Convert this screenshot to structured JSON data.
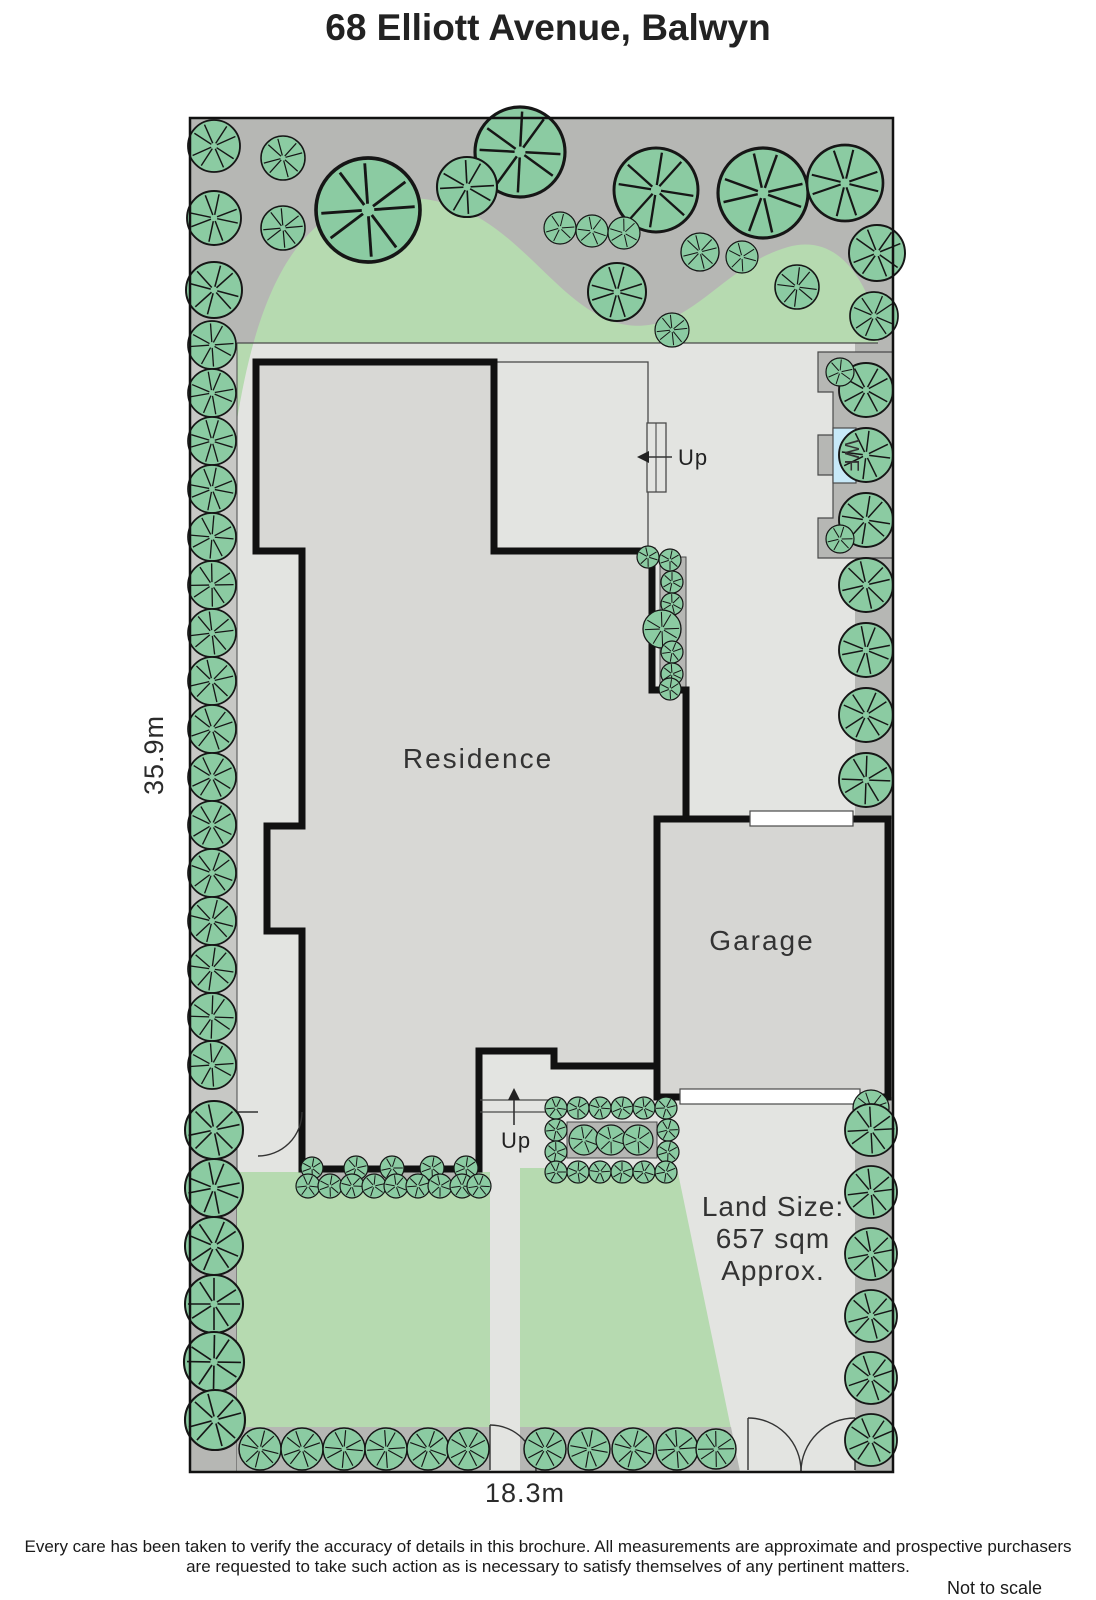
{
  "title": "68 Elliott Avenue, Balwyn",
  "labels": {
    "residence": "Residence",
    "garage": "Garage",
    "up_rear": "Up",
    "up_front": "Up",
    "water_feature": "WF",
    "land_size_line1": "Land Size:",
    "land_size_line2": "657 sqm",
    "land_size_line3": "Approx.",
    "depth_dim": "35.9m",
    "width_dim": "18.3m",
    "not_to_scale": "Not to scale"
  },
  "disclaimer": {
    "line1": "Every care has been taken to verify the accuracy of details in this brochure.  All measurements are approximate and prospective purchasers",
    "line2": "are requested to take such action as is necessary to satisfy themselves of any pertinent matters."
  },
  "colors": {
    "bed_gray": "#b6b7b4",
    "left_strip_gray": "#c7c8c5",
    "paving_gray": "#e3e4e1",
    "residence_fill": "#d8d8d5",
    "garage_fill": "#d6d6d3",
    "lawn_green": "#b6dab0",
    "tree_fill": "#8bcba2",
    "tree_stroke": "#161616",
    "wf_blue": "#c7e9f8",
    "wall_black": "#111111",
    "thin_line": "#4a4a4a"
  },
  "trees": {
    "top_garden": [
      [
        368,
        210,
        52
      ],
      [
        520,
        152,
        45
      ],
      [
        656,
        190,
        42
      ],
      [
        763,
        193,
        45
      ],
      [
        845,
        183,
        38
      ],
      [
        467,
        187,
        30
      ],
      [
        877,
        253,
        28
      ],
      [
        214,
        146,
        26
      ],
      [
        283,
        158,
        22
      ],
      [
        214,
        218,
        27
      ],
      [
        283,
        228,
        22
      ],
      [
        214,
        290,
        28
      ],
      [
        560,
        228,
        16
      ],
      [
        592,
        231,
        16
      ],
      [
        624,
        233,
        16
      ],
      [
        700,
        252,
        19
      ],
      [
        742,
        257,
        16
      ],
      [
        672,
        330,
        17
      ],
      [
        617,
        292,
        29
      ],
      [
        797,
        287,
        22
      ],
      [
        874,
        316,
        24
      ]
    ],
    "left_col": [
      [
        212,
        345,
        24
      ],
      [
        212,
        393,
        24
      ],
      [
        212,
        441,
        24
      ],
      [
        212,
        489,
        24
      ],
      [
        212,
        537,
        24
      ],
      [
        212,
        585,
        24
      ],
      [
        212,
        633,
        24
      ],
      [
        212,
        681,
        24
      ],
      [
        212,
        729,
        24
      ],
      [
        212,
        777,
        24
      ],
      [
        212,
        825,
        24
      ],
      [
        212,
        873,
        24
      ],
      [
        212,
        921,
        24
      ],
      [
        212,
        969,
        24
      ],
      [
        212,
        1017,
        24
      ],
      [
        212,
        1065,
        24
      ]
    ],
    "left_bottom": [
      [
        214,
        1130,
        29
      ],
      [
        214,
        1188,
        29
      ],
      [
        214,
        1246,
        29
      ],
      [
        214,
        1304,
        29
      ],
      [
        214,
        1362,
        30
      ],
      [
        215,
        1420,
        30
      ]
    ],
    "right_col_top": [
      [
        866,
        390,
        27
      ],
      [
        866,
        455,
        27
      ],
      [
        866,
        520,
        27
      ],
      [
        866,
        585,
        27
      ],
      [
        866,
        650,
        27
      ],
      [
        866,
        715,
        27
      ],
      [
        866,
        780,
        27
      ],
      [
        840,
        372,
        14
      ],
      [
        840,
        539,
        14
      ]
    ],
    "right_col_bottom": [
      [
        871,
        1108,
        18
      ],
      [
        871,
        1130,
        26
      ],
      [
        871,
        1192,
        26
      ],
      [
        871,
        1254,
        26
      ],
      [
        871,
        1316,
        26
      ],
      [
        871,
        1378,
        26
      ],
      [
        871,
        1440,
        26
      ]
    ],
    "east_hedge": [
      [
        648,
        557,
        11
      ],
      [
        670,
        560,
        11
      ],
      [
        672,
        582,
        11
      ],
      [
        672,
        604,
        11
      ],
      [
        662,
        629,
        19
      ],
      [
        672,
        652,
        11
      ],
      [
        672,
        674,
        11
      ],
      [
        670,
        689,
        11
      ]
    ],
    "south_hedge": [
      [
        312,
        1168,
        11
      ],
      [
        356,
        1168,
        12
      ],
      [
        392,
        1168,
        12
      ],
      [
        432,
        1168,
        12
      ],
      [
        466,
        1168,
        12
      ],
      [
        308,
        1186,
        12
      ],
      [
        330,
        1186,
        12
      ],
      [
        352,
        1186,
        12
      ],
      [
        374,
        1186,
        12
      ],
      [
        396,
        1186,
        12
      ],
      [
        418,
        1186,
        12
      ],
      [
        440,
        1186,
        12
      ],
      [
        462,
        1186,
        12
      ],
      [
        479,
        1186,
        12
      ]
    ],
    "hedge_box_ring": [
      [
        556,
        1108,
        11
      ],
      [
        578,
        1108,
        11
      ],
      [
        600,
        1108,
        11
      ],
      [
        622,
        1108,
        11
      ],
      [
        644,
        1108,
        11
      ],
      [
        666,
        1108,
        11
      ],
      [
        556,
        1130,
        11
      ],
      [
        556,
        1152,
        11
      ],
      [
        668,
        1130,
        11
      ],
      [
        668,
        1152,
        11
      ],
      [
        556,
        1172,
        11
      ],
      [
        578,
        1172,
        11
      ],
      [
        600,
        1172,
        11
      ],
      [
        622,
        1172,
        11
      ],
      [
        644,
        1172,
        11
      ],
      [
        666,
        1172,
        11
      ]
    ],
    "hedge_box_inner": [
      [
        584,
        1140,
        15
      ],
      [
        611,
        1140,
        15
      ],
      [
        638,
        1140,
        15
      ]
    ],
    "bottom_bed1": [
      [
        260,
        1449,
        21
      ],
      [
        302,
        1449,
        21
      ],
      [
        344,
        1449,
        21
      ],
      [
        386,
        1449,
        21
      ],
      [
        428,
        1449,
        21
      ],
      [
        468,
        1449,
        21
      ]
    ],
    "bottom_bed2": [
      [
        545,
        1449,
        21
      ],
      [
        589,
        1449,
        21
      ],
      [
        633,
        1449,
        21
      ],
      [
        677,
        1449,
        21
      ],
      [
        716,
        1449,
        20
      ]
    ]
  }
}
